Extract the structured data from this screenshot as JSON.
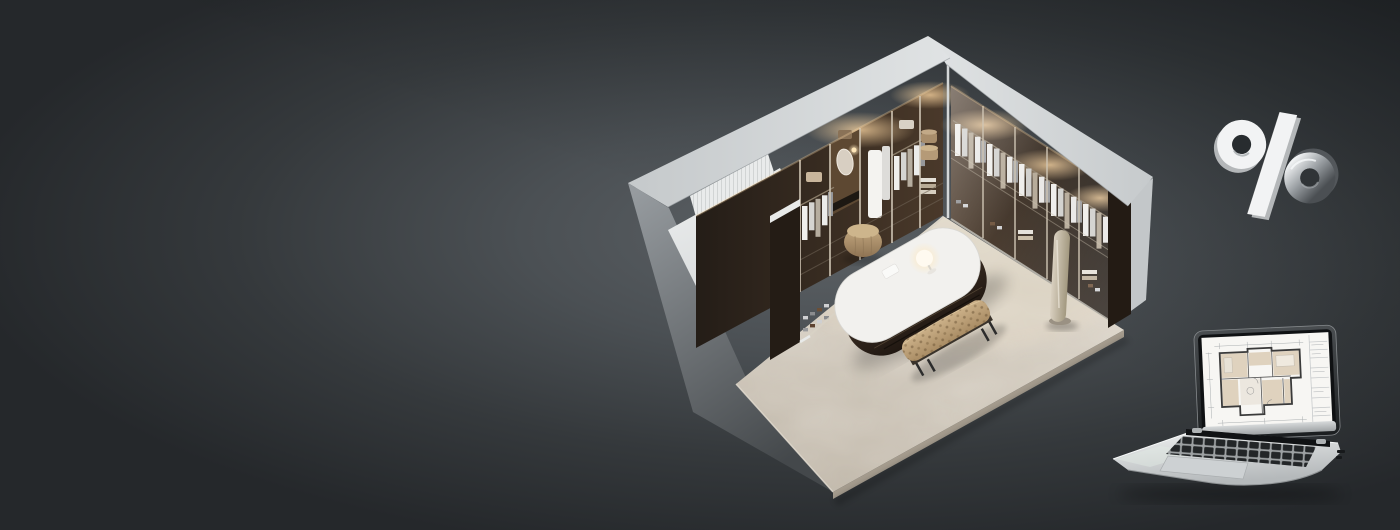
{
  "banner": {
    "name": "interior-design-promo-banner",
    "background": {
      "glow": "#5d6266",
      "mid": "#4b5054",
      "dim": "#35393c",
      "edge": "#25282b"
    },
    "room": {
      "name": "isometric-walk-in-closet-render",
      "wall_top": "#e0e3e4",
      "wall_exterior_light": "#969b9f",
      "wall_exterior_dark": "#44484b",
      "wall_end_face": "#c3c7c9",
      "wardrobe_interior_dark": "#241d17",
      "wardrobe_interior_warm": "#4a392a",
      "wardrobe_frame": "#cfc5b4",
      "curtain": "#f2f3f3",
      "bed_platform": "#eff1f1",
      "floor_light": "#dbd4c8",
      "floor_dark": "#bfb6a8",
      "floor_edge": "#a59c8e",
      "island_body": "#45372a",
      "island_top": "#f2f1ee",
      "bench": "#ccb189",
      "pouf": "#c6ab82",
      "mirror": "#d9d0c0",
      "lamp_glow": "#ffe9bf",
      "light_glow": "#ffd9a4"
    },
    "percent_icon": {
      "symbol": "%",
      "face": "#f2f3f4",
      "depth": "#b4b7b9",
      "chrome_light": "#f0f2f3",
      "chrome_mid": "#9ba0a4",
      "chrome_dark": "#4b4f53",
      "hole": "#282c2f"
    },
    "laptop": {
      "name": "laptop-floorplan-render",
      "body_light": "#f0f2f2",
      "body_dark": "#b5b9bb",
      "bezel": "#0f1113",
      "screen": "#f7f6f3",
      "hinge": "#101214",
      "keys": "#232628",
      "trackpad": "#cdd1d3",
      "plan_wall": "#3a3a3a",
      "plan_room_fill": "#dbccb5",
      "plan_line": "#9aa0a4"
    }
  }
}
